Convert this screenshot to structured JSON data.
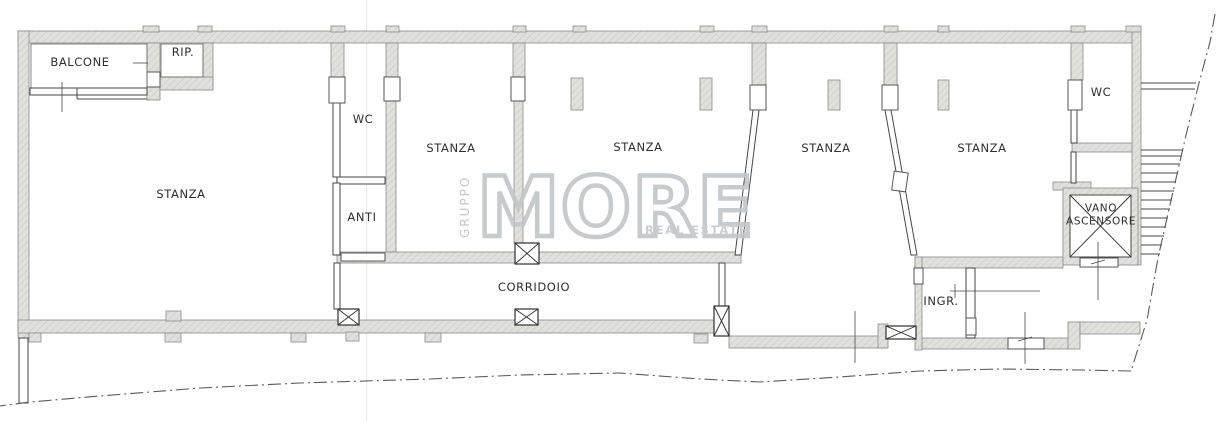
{
  "document": {
    "type": "floor-plan"
  },
  "rooms": [
    {
      "id": "balcone",
      "label": "BALCONE"
    },
    {
      "id": "rip",
      "label": "RIP."
    },
    {
      "id": "stanza-1",
      "label": "STANZA"
    },
    {
      "id": "wc-1",
      "label": "WC"
    },
    {
      "id": "anti",
      "label": "ANTI"
    },
    {
      "id": "stanza-2",
      "label": "STANZA"
    },
    {
      "id": "stanza-3",
      "label": "STANZA"
    },
    {
      "id": "corridoio",
      "label": "CORRIDOIO"
    },
    {
      "id": "stanza-4",
      "label": "STANZA"
    },
    {
      "id": "stanza-5",
      "label": "STANZA"
    },
    {
      "id": "ingr",
      "label": "INGR."
    },
    {
      "id": "wc-2",
      "label": "WC"
    },
    {
      "id": "vano-ascensore",
      "label": "VANO ASCENSORE"
    }
  ],
  "watermark": {
    "vertical_text": "GRUPPO",
    "brand": "MORE",
    "tagline": "REAL ESTATE"
  },
  "colors": {
    "wall_fill": "#e0e1dd",
    "drawing_line": "#464646",
    "watermark_gray": "#c3c6c8",
    "boundary_line": "#5a5a5a"
  }
}
